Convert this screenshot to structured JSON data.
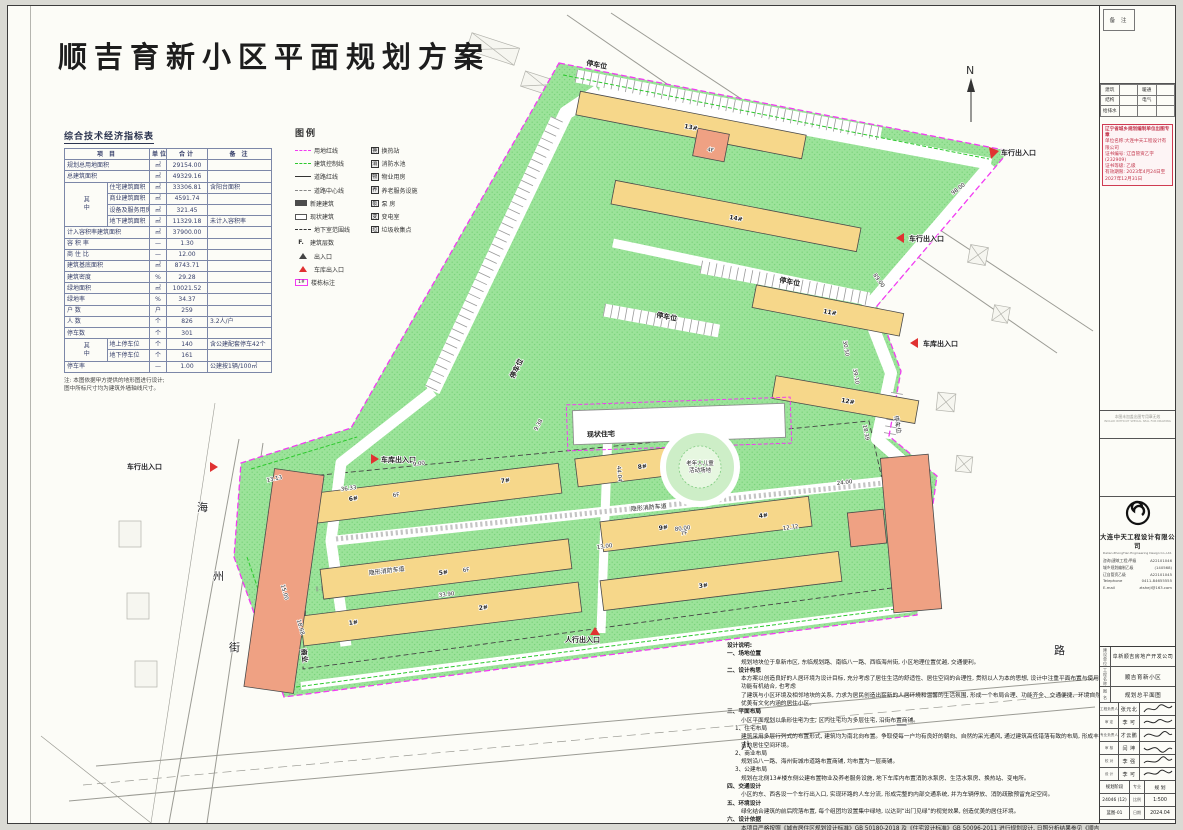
{
  "title": "顺吉育新小区平面规划方案",
  "north": {
    "label": "N"
  },
  "ind": {
    "title": "综合技术经济指标表",
    "headers": [
      "项  目",
      "单位",
      "合计",
      "备  注"
    ],
    "among": "其中",
    "rows": [
      [
        "规划总用地面积",
        "㎡",
        "29154.00",
        ""
      ],
      [
        "总建筑面积",
        "㎡",
        "49329.16",
        ""
      ],
      [
        "住宅建筑面积",
        "㎡",
        "33306.81",
        "含阳台面积"
      ],
      [
        "商业建筑面积",
        "㎡",
        "4591.74",
        ""
      ],
      [
        "设备及服务用房",
        "㎡",
        "321.45",
        ""
      ],
      [
        "地下建筑面积",
        "㎡",
        "11329.18",
        "未计入容积率"
      ],
      [
        "计入容积率建筑面积",
        "㎡",
        "37900.00",
        ""
      ],
      [
        "容 积 率",
        "—",
        "1.30",
        ""
      ],
      [
        "商 住 比",
        "—",
        "12.00",
        ""
      ],
      [
        "建筑基底面积",
        "㎡",
        "8743.71",
        ""
      ],
      [
        "建筑密度",
        "%",
        "29.28",
        ""
      ],
      [
        "绿地面积",
        "㎡",
        "10021.52",
        ""
      ],
      [
        "绿地率",
        "%",
        "34.37",
        ""
      ],
      [
        "户  数",
        "户",
        "259",
        ""
      ],
      [
        "人  数",
        "个",
        "826",
        "3.2人/户"
      ],
      [
        "停车数",
        "个",
        "301",
        ""
      ],
      [
        "地上停车位",
        "个",
        "140",
        "含公建配套停车42个"
      ],
      [
        "地下停车位",
        "个",
        "161",
        ""
      ],
      [
        "停车率",
        "—",
        "1.00",
        "公建按1辆/100㎡"
      ]
    ],
    "fn1": "注: 本图依据甲方提供的地形图进行设计;",
    "fn2": "图中所标尺寸均为建筑外墙轴线尺寸。"
  },
  "legend": {
    "title": "图例",
    "fsym": "F.",
    "bno": "1#",
    "lines": [
      "用地红线",
      "建筑控制线",
      "道路红线",
      "道路中心线",
      "新建建筑",
      "现状建筑",
      "地下室范围线",
      "建筑层数",
      "出入口",
      "车库出入口",
      "楼栋标注"
    ],
    "marks": [
      {
        "ic": "换",
        "t": "换热站"
      },
      {
        "ic": "消",
        "t": "消防水池"
      },
      {
        "ic": "物",
        "t": "物业用房"
      },
      {
        "ic": "养",
        "t": "养老服务设施"
      },
      {
        "ic": "泵",
        "t": "泵  房"
      },
      {
        "ic": "变",
        "t": "变电室"
      },
      {
        "ic": "垃",
        "t": "垃圾收集点"
      }
    ]
  },
  "plan": {
    "labels": [
      "停车位",
      "停车位",
      "停车位",
      "停车位",
      "停车位",
      "车行出入口",
      "车行出入口",
      "车库出入口",
      "车库出入口",
      "车行出入口",
      "人行出入口",
      "现状住宅",
      "老年人儿童",
      "活动场地",
      "隐形消防车道",
      "隐形消防车道",
      "商业",
      "海",
      "州",
      "街",
      "八",
      "一",
      "路",
      "13#",
      "14#",
      "11#",
      "12#",
      "6#",
      "7#",
      "8#",
      "5#",
      "9#",
      "4#",
      "1#",
      "2#",
      "3#",
      "6F",
      "6F",
      "7F",
      "4F",
      "98.00",
      "89.00",
      "39.10",
      "18.39",
      "13.13",
      "36.33",
      "9.00",
      "15.00",
      "18.68",
      "33.90",
      "13.00",
      "12.72",
      "24.00",
      "9.38",
      "44.04",
      "80.00",
      "30.50"
    ]
  },
  "notes": {
    "lines": [
      "设计说明:",
      "一、场地位置",
      "规划地块位于阜新市区, 东临规划路、南临八一路、西临海州街, 小区地理位置优越, 交通便利。",
      "二、设计构思",
      "本方案以创造良好的人居环境为设计目标, 充分考虑了居住生活的舒适性、居住空间的合理性, 贯彻以人为本的思想, 设计中注重平面布置与使用功能有机结合, 也考虑",
      "了建筑与小区环境及相邻地块的关系, 力求为居民创造出崭新的人居环境和温馨的生活氛围, 形成一个布局合理、功能齐全、交通便捷、环境自然优美有文化内涵的居住小区。",
      "三、平面布局",
      "小区平面规划以条形住宅为主, 区内住宅均为多层住宅, 沿街布置商铺。",
      "1、住宅布局",
      "建筑采用多层行列式的布置形式, 建筑均为南北向布置。争取使每一户均有良好的朝向、自然的采光通风, 通过建筑高低错落有致的布局, 形成丰富的居住空间环境。",
      "2、商业布局",
      "规划沿八一路、海州街城市道路布置商铺, 均布置为一层商铺。",
      "3、公建布局",
      "规划在北侧13#楼东侧公建布置物业及养老服务设施, 地下车库内布置消防水泵房、生活水泵房、换热站、变电所。",
      "四、交通设计",
      "小区的东、西各设一个车行出入口, 实现环路的人车分流, 形成完整的内部交通系统, 并为车辆停放、消防疏散预留充足空间。",
      "五、环境设计",
      "绿化结合建筑的前后院落布置, 每个组团均设置集中绿地, 以达到“出门见绿”的视觉效果, 创造优美的居住环境。",
      "六、设计依据",
      "本项目严格按照《城市居住区规划设计标准》GB 50180-2018 及《住宅设计标准》GB 50096-2011 进行规划设计, 日照分析结果参见《顺吉育新小区项目日照分析报告书》。"
    ]
  },
  "sidebar": {
    "remark": "备 注",
    "disc": {
      "r0c0": "建筑",
      "r0c2": "暖通",
      "r1c0": "结构",
      "r1c2": "电气",
      "r2c0": "给排水"
    },
    "stamp": {
      "l1": "辽宁省城乡规划编制单位出图专章",
      "l2": "单位名称:大连中天工程设计有限公司",
      "l3": "证书编号: 辽自管资乙字(232909)",
      "l4": "证书等级: 乙级",
      "l5": "有效期限: 2023年4月24日至2027年12月31日"
    },
    "fine": {
      "l1": "本图未加盖出图专用章无效",
      "l2": "INVALID WITHOUT SPECIAL SEAL FOR DRAWING"
    },
    "company": {
      "name": "大连中天工程设计有限公司",
      "en": "Dalian ZhongTian Engineering Design Co.,Ltd.",
      "certs": [
        [
          "咨询(建筑工程)甲级",
          "A22101046"
        ],
        [
          "城乡规划编制乙级",
          "(140568)"
        ],
        [
          "辽自管资乙级",
          "A22101045"
        ],
        [
          "Telephone",
          "0411-84655555"
        ],
        [
          "E-mail",
          "ztsheji@163.com"
        ]
      ]
    },
    "tb": {
      "owner_label": "建设单位",
      "owner": "阜新顺吉房地产开发公司",
      "project_label": "工程名称",
      "project": "顺吉育新小区",
      "drawing_label": "图 名",
      "drawing": "规划总平面图",
      "people": [
        [
          "工程负责人",
          "张元北"
        ],
        [
          "审  定",
          "李 可"
        ],
        [
          "专业负责人",
          "才云鹏"
        ],
        [
          "审  核",
          "闫 坤"
        ],
        [
          "校  对",
          "李 强"
        ],
        [
          "设  计",
          "李 可"
        ]
      ],
      "meta": [
        [
          "规划阶段",
          "专业",
          "规 划"
        ],
        [
          "24046 (12)",
          "比例",
          "1:500"
        ],
        [
          "蓝图-01",
          "日期",
          "2024.04"
        ]
      ]
    }
  }
}
